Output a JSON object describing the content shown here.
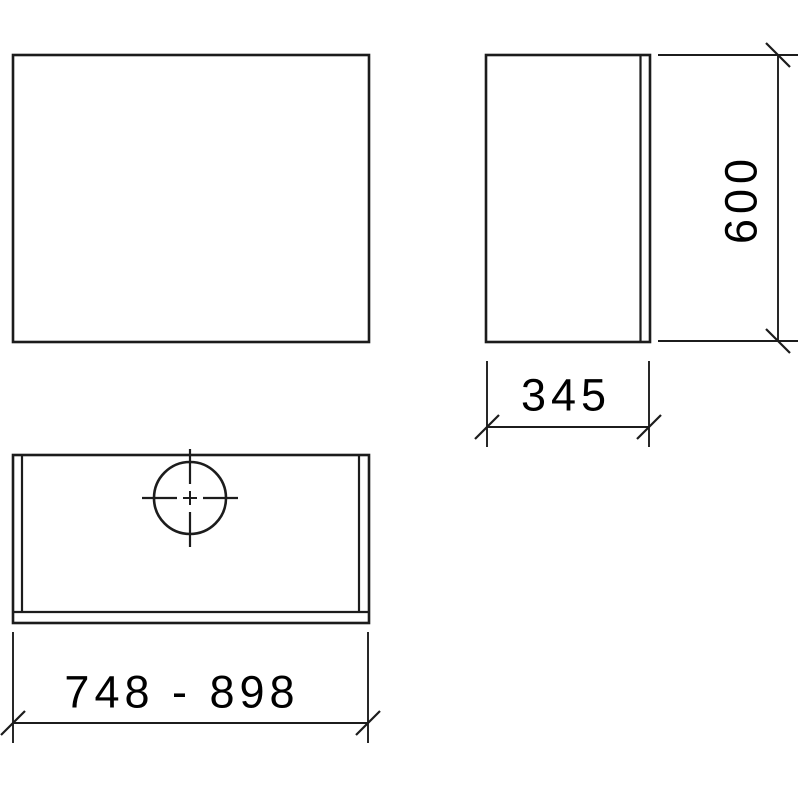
{
  "drawing": {
    "background_color": "#ffffff",
    "line_color": "#1c1c1c",
    "text_color": "#000000",
    "dimensions": {
      "height": {
        "value": "600",
        "unit": "mm-implied",
        "orientation": "vertical"
      },
      "depth": {
        "value": "345",
        "unit": "mm-implied",
        "orientation": "horizontal"
      },
      "width_range": {
        "value": "748 - 898",
        "unit": "mm-implied",
        "orientation": "horizontal"
      }
    }
  }
}
